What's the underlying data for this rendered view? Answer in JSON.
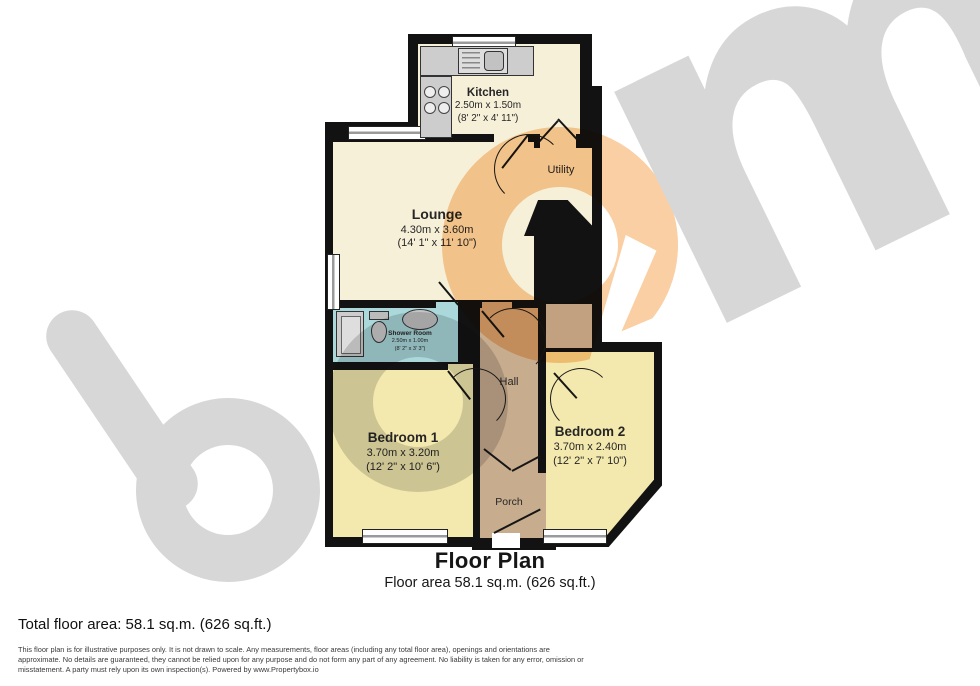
{
  "colors": {
    "wall": "#121212",
    "room-cream": "#F7F0D9",
    "room-yellow": "#F3E9AE",
    "room-teal": "#AAD8DB",
    "room-tan": "#C7AC8E",
    "room-gray": "#C6C6C6",
    "fixture-gray": "#CDCDCD",
    "wm-gray": "#D7D7D7",
    "wm-orange": "#F9CFA3",
    "text-dark": "#1F1F1F"
  },
  "watermark": {
    "brand": "boom",
    "m_letter": "m"
  },
  "rooms": {
    "kitchen": {
      "name": "Kitchen",
      "metric": "2.50m x 1.50m",
      "imperial": "(8' 2\" x 4' 11\")"
    },
    "utility": {
      "name": "Utility"
    },
    "lounge": {
      "name": "Lounge",
      "metric": "4.30m x 3.60m",
      "imperial": "(14' 1\" x 11' 10\")"
    },
    "shower": {
      "name": "Shower Room",
      "metric": "2.50m x 1.00m",
      "imperial": "(8' 2\" x 3' 3\")"
    },
    "hall": {
      "name": "Hall"
    },
    "bedroom1": {
      "name": "Bedroom 1",
      "metric": "3.70m x 3.20m",
      "imperial": "(12' 2\" x 10' 6\")"
    },
    "bedroom2": {
      "name": "Bedroom 2",
      "metric": "3.70m x 2.40m",
      "imperial": "(12' 2\" x 7' 10\")"
    },
    "porch": {
      "name": "Porch"
    }
  },
  "footer": {
    "title": "Floor Plan",
    "subtitle": "Floor area 58.1 sq.m. (626 sq.ft.)",
    "total": "Total floor area: 58.1 sq.m. (626 sq.ft.)",
    "disclaimer_lines": [
      "This floor plan is for illustrative purposes only. It is not drawn to scale. Any measurements, floor areas (including any total floor area), openings and orientations are",
      "approximate. No details are guaranteed, they cannot be relied upon for any purpose and do not form any part of any agreement. No liability is taken for any error, omission or",
      "misstatement. A party must rely upon its own inspection(s). Powered by www.Propertybox.io"
    ]
  }
}
